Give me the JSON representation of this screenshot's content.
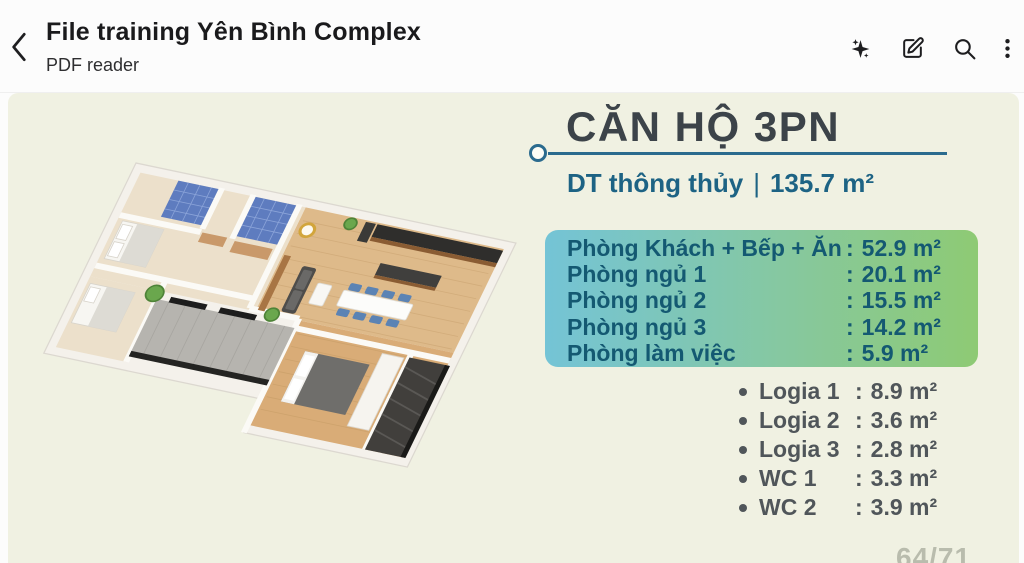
{
  "header": {
    "title": "File training Yên Bình Complex",
    "subtitle": "PDF reader",
    "actions": {
      "ai": "ai-sparkle-icon",
      "edit": "edit-icon",
      "search": "search-icon",
      "more": "kebab-menu-icon"
    }
  },
  "document": {
    "title": "CĂN HỘ 3PN",
    "area_label": "DT thông thủy",
    "area_divider": "|",
    "area_value": "135.7 m²",
    "colon": ":",
    "rooms": [
      {
        "label": "Phòng Khách + Bếp + Ăn",
        "value": "52.9 m²"
      },
      {
        "label": "Phòng ngủ 1",
        "value": "20.1 m²"
      },
      {
        "label": "Phòng ngủ 2",
        "value": "15.5 m²"
      },
      {
        "label": "Phòng ngủ 3",
        "value": "14.2 m²"
      },
      {
        "label": "Phòng làm việc",
        "value": "5.9 m²"
      }
    ],
    "extras": [
      {
        "label": "Logia 1",
        "value": "8.9 m²"
      },
      {
        "label": "Logia 2",
        "value": "3.6 m²"
      },
      {
        "label": "Logia 3",
        "value": "2.8 m²"
      },
      {
        "label": "WC 1",
        "value": "3.3 m²"
      },
      {
        "label": "WC 2",
        "value": "3.9 m²"
      }
    ],
    "page_indicator": "64/71",
    "floor_plan_alt": "3D floor plan of 3-bedroom apartment"
  },
  "colors": {
    "page_bg": "#f0f1e2",
    "accent_teal": "#1d6384",
    "rule_teal": "#2b6b8e",
    "box_gradient_left": "#74c4d6",
    "box_gradient_right": "#8eca74",
    "box_text": "#145972",
    "extras_text": "#50565a",
    "doc_title_text": "#3c4349",
    "page_num_text": "#b9bcad"
  }
}
